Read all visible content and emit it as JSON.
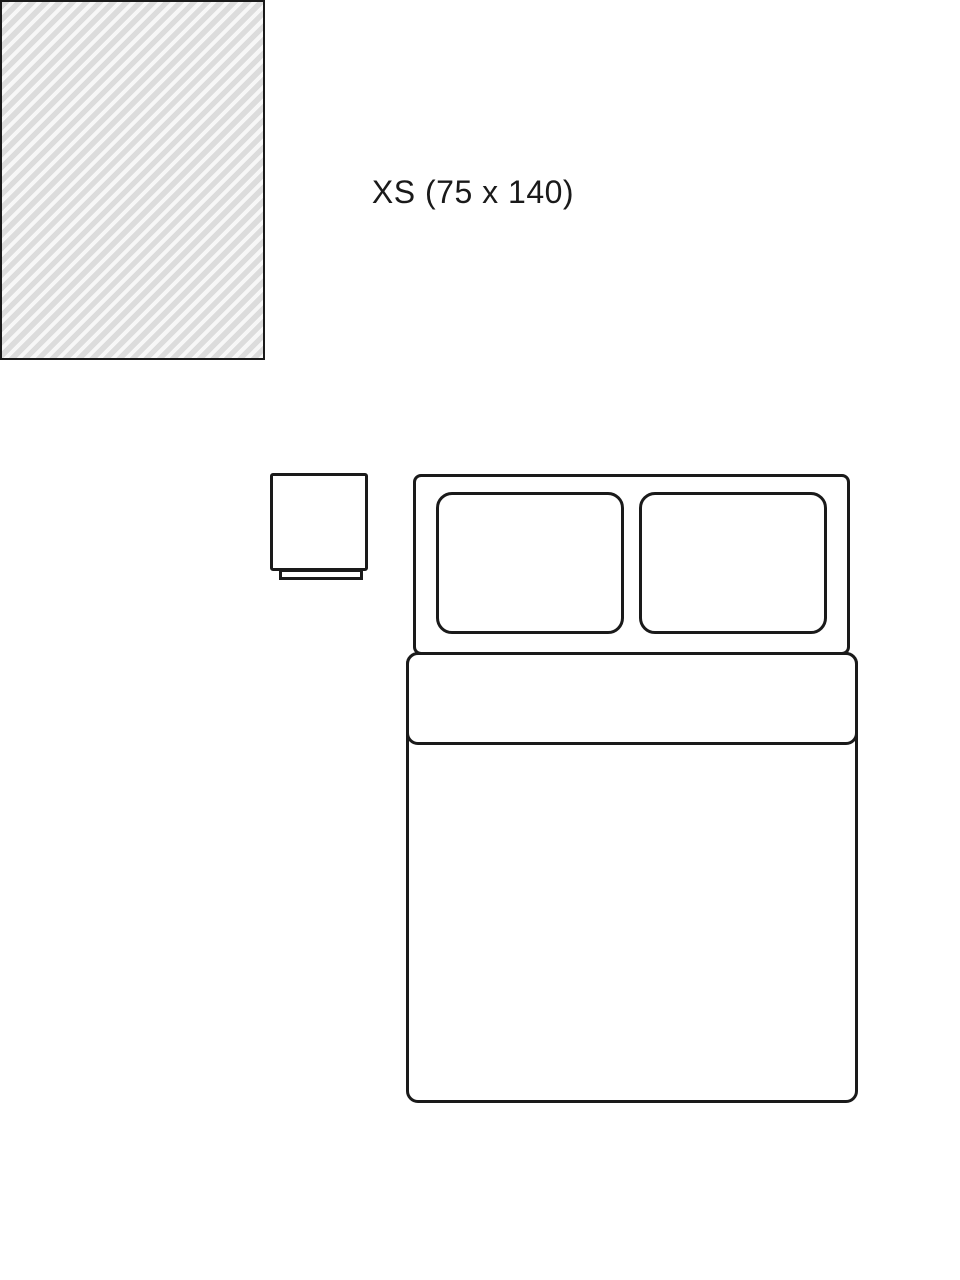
{
  "size_diagram": {
    "title": "XS (75 x 140)",
    "colors": {
      "background": "#ffffff",
      "line": "#1a1a1a",
      "rug_fill": "#dcdcdc",
      "rug_stripe": "#f7f7f7"
    }
  }
}
